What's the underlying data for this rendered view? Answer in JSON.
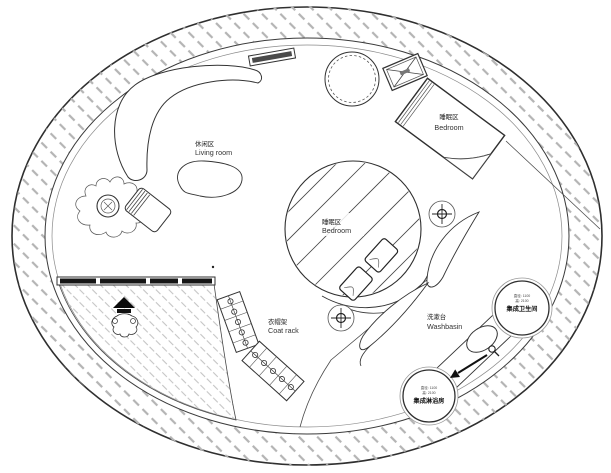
{
  "plan": {
    "areas": {
      "living_room": {
        "zh": "休闲区",
        "en": "Living room"
      },
      "bedroom_upper": {
        "zh": "睡眠区",
        "en": "Bedroom"
      },
      "bedroom_center": {
        "zh": "睡眠区",
        "en": "Bedroom"
      },
      "coat_rack": {
        "zh": "衣帽架",
        "en": "Coat rack"
      },
      "washbasin": {
        "zh": "洗漱台",
        "en": "Washbasin"
      },
      "bathroom_pod": {
        "dim_line1": "直径: 1100",
        "dim_line2": "高: 2100",
        "name": "集成卫生间"
      },
      "shower_pod": {
        "dim_line1": "直径: 1100",
        "dim_line2": "高: 2100",
        "name": "集成淋浴房"
      }
    },
    "colors": {
      "line": "#2f2f2f",
      "wall_hatch": "#b4b4b4",
      "deck_hatch": "#c4c4c4",
      "background": "#ffffff"
    }
  }
}
